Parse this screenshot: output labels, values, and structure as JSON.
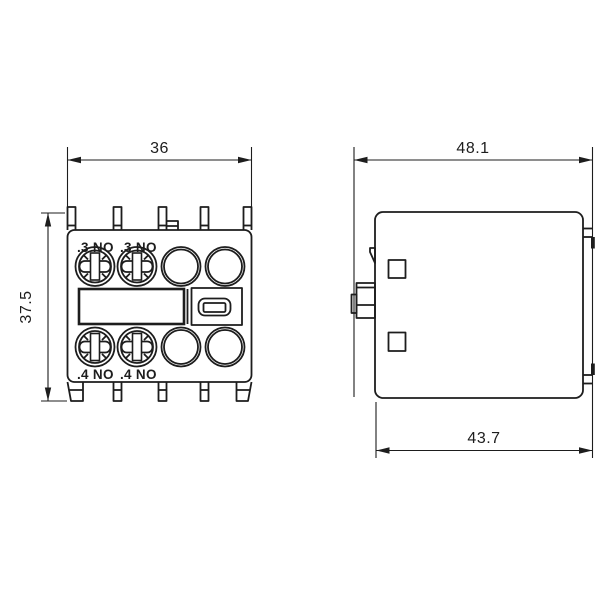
{
  "drawing": {
    "type": "technical-dimension-drawing",
    "background_color": "#ffffff",
    "line_color": "#1d1d1d",
    "views": {
      "front": {
        "label": "front-view",
        "dim_width": "36",
        "dim_height": "37.5",
        "terminals_top": [
          ".3 NO",
          ".3 NO"
        ],
        "terminals_bottom": [
          ".4 NO",
          ".4 NO"
        ]
      },
      "side": {
        "label": "side-view",
        "dim_width_top": "48.1",
        "dim_width_bottom": "43.7"
      }
    }
  }
}
